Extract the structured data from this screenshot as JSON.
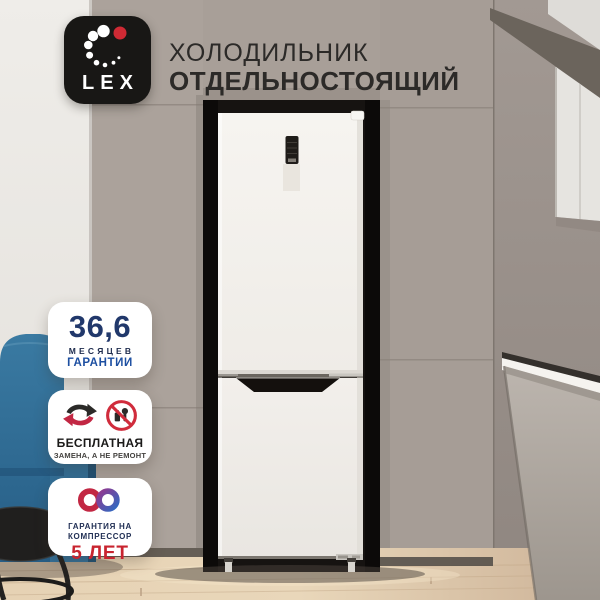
{
  "header": {
    "brand": "LEX",
    "title_line1": "ХОЛОДИЛЬНИК",
    "title_line2": "ОТДЕЛЬНОСТОЯЩИЙ"
  },
  "badges": [
    {
      "value": "36,6",
      "caption_line1": "МЕСЯЦЕВ",
      "caption_line2": "ГАРАНТИИ"
    },
    {
      "title": "БЕСПЛАТНАЯ",
      "subtitle": "ЗАМЕНА, А НЕ РЕМОНТ"
    },
    {
      "caption_line1": "ГАРАНТИЯ НА",
      "caption_line2": "КОМПРЕССОР",
      "value": "5 ЛЕТ"
    }
  ],
  "colors": {
    "brand_red": "#cf2a34",
    "title_text": "#2c2a28",
    "badge_navy": "#21386b",
    "badge_blue": "#1d4fa1",
    "badge_red": "#c8242f",
    "accent_crimson": "#c22743",
    "prohibition_red": "#d02c3c",
    "icon_dark": "#2b2a28"
  }
}
